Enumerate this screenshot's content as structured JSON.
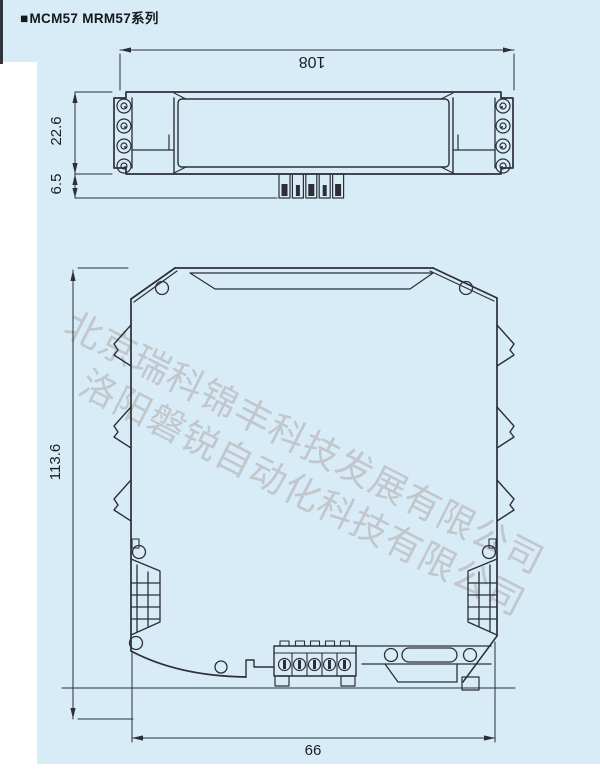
{
  "header": {
    "marker": "■",
    "title": "MCM57 MRM57系列"
  },
  "watermarks": {
    "line1": "北京瑞科锦丰科技发展有限公司",
    "line2": "洛阳磐锐自动化科技有限公司"
  },
  "top_view": {
    "dims": {
      "width": "108",
      "height": "22.6",
      "pin_length": "6.5"
    }
  },
  "front_view": {
    "dims": {
      "height": "113.6",
      "width": "66"
    }
  },
  "colors": {
    "background": "#d8ecf8",
    "line": "#2c2f36",
    "watermark": "#c0c3c7",
    "label_text": "#1a1d22",
    "page_margin": "#ffffff"
  }
}
